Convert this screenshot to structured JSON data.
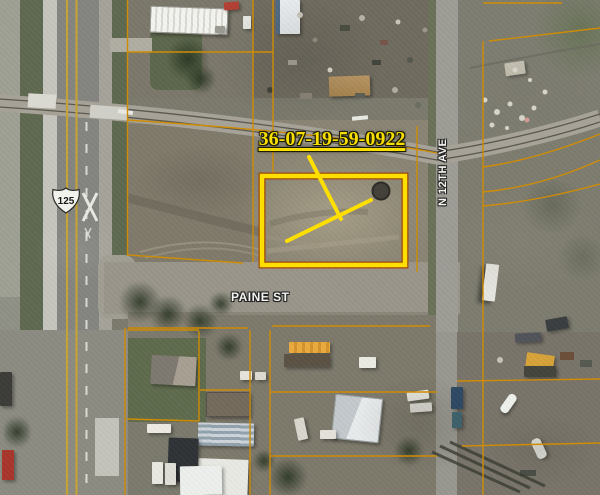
{
  "map": {
    "parcel_id_label": "36-07-19-59-0922",
    "street_labels": {
      "paine_st": "PAINE ST",
      "n_12th_ave": "N 12TH AVE"
    },
    "route_shield_number": "125",
    "colors": {
      "parcel_highlight_yellow": "#ffdf00",
      "parcel_line_orange": "#cf8c05",
      "parcel_label_yellow": "#f8df00",
      "street_label_white": "#f4f4f0"
    }
  }
}
